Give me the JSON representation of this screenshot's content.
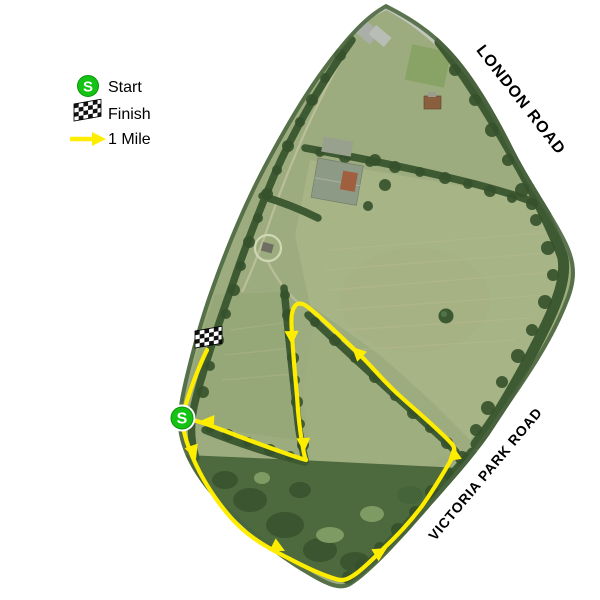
{
  "legend": {
    "start": {
      "symbol": "S",
      "label": "Start"
    },
    "finish": {
      "label": "Finish"
    },
    "mile": {
      "label": "1 Mile"
    }
  },
  "roads": {
    "top_label": "LONDON ROAD",
    "bottom_label": "VICTORIA PARK ROAD"
  },
  "course": {
    "start_symbol": "S",
    "direction_arrow_count": 8
  },
  "colors": {
    "course": "#ffed00",
    "start_marker": "#14c314",
    "start_marker_edge": "#0d930d",
    "road_label_text": "#000000"
  }
}
